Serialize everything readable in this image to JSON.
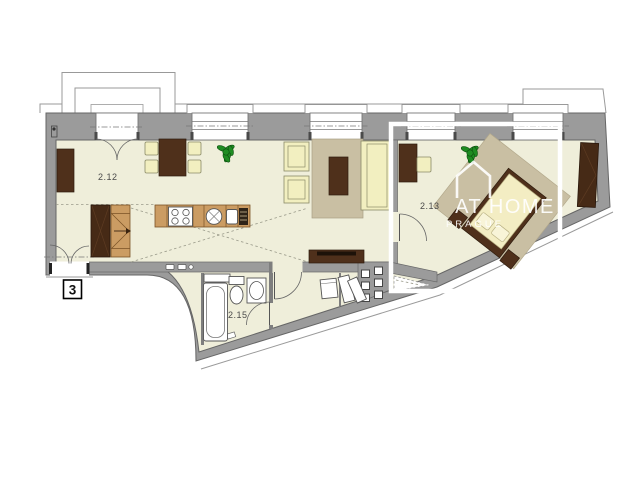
{
  "plan": {
    "unit_badge": "3",
    "watermark": {
      "brand": "AT HOME",
      "city": "PRAGUE"
    },
    "rooms": [
      {
        "label": "2.12"
      },
      {
        "label": "2.13"
      },
      {
        "label": "2.15"
      }
    ],
    "colors": {
      "background": "#ffffff",
      "floor": "#efeeda",
      "wall": "#9b9b9b",
      "wall_edge": "#666666",
      "wood_dark": "#4f301b",
      "wood_light": "#cb9c63",
      "upholstery": "#f2efc0",
      "rug": "#c9bfa3",
      "plant_green": "#1f8c22",
      "highlight": "#ffffff"
    }
  }
}
